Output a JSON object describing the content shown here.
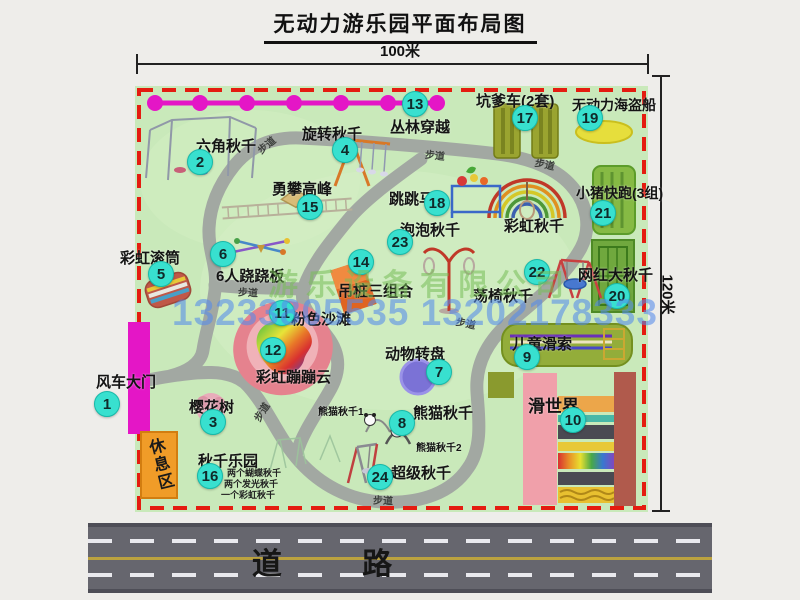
{
  "title": "无动力游乐园平面布局图",
  "dimensions": {
    "top": "100米",
    "right": "120米"
  },
  "road": {
    "label": "道 路"
  },
  "watermark": {
    "company": "游乐设备有限公司",
    "phone": "13233805535 13202178333"
  },
  "rest_area": {
    "label": "休息区"
  },
  "walkway_label": "步道",
  "walkway_positions": [
    [
      256,
      137,
      -40
    ],
    [
      425,
      147,
      6
    ],
    [
      535,
      156,
      12
    ],
    [
      238,
      284,
      3
    ],
    [
      251,
      404,
      -58
    ],
    [
      456,
      315,
      12
    ],
    [
      373,
      492,
      2
    ]
  ],
  "attractions": [
    {
      "num": "1",
      "name": "风车大门",
      "badge": [
        107,
        404
      ],
      "label": [
        96,
        371
      ]
    },
    {
      "num": "2",
      "name": "六角秋千",
      "badge": [
        200,
        162
      ],
      "label": [
        196,
        135
      ]
    },
    {
      "num": "3",
      "name": "樱花树",
      "badge": [
        213,
        422
      ],
      "label": [
        189,
        396
      ]
    },
    {
      "num": "4",
      "name": "旋转秋千",
      "badge": [
        345,
        150
      ],
      "label": [
        302,
        123
      ]
    },
    {
      "num": "5",
      "name": "彩虹滚筒",
      "badge": [
        161,
        274
      ],
      "label": [
        120,
        247
      ]
    },
    {
      "num": "6",
      "name": "6人跷跷板",
      "badge": [
        223,
        254
      ],
      "label": [
        216,
        265
      ]
    },
    {
      "num": "7",
      "name": "动物转盘",
      "badge": [
        439,
        372
      ],
      "label": [
        385,
        343
      ]
    },
    {
      "num": "8",
      "name": "熊猫秋千",
      "badge": [
        402,
        423
      ],
      "label": [
        413,
        402
      ]
    },
    {
      "num": "9",
      "name": "儿童滑索",
      "badge": [
        527,
        357
      ],
      "label": [
        512,
        333
      ]
    },
    {
      "num": "10",
      "name": "滑世界",
      "badge": [
        573,
        420
      ],
      "label": [
        528,
        392
      ],
      "size": 17
    },
    {
      "num": "11",
      "name": "粉色沙滩",
      "badge": [
        282,
        313
      ],
      "label": [
        291,
        308
      ]
    },
    {
      "num": "12",
      "name": "彩虹蹦蹦云",
      "badge": [
        273,
        350
      ],
      "label": [
        256,
        366
      ]
    },
    {
      "num": "13",
      "name": "丛林穿越",
      "badge": [
        415,
        104
      ],
      "label": [
        390,
        116
      ]
    },
    {
      "num": "14",
      "name": "吊桩三组合",
      "badge": [
        361,
        262
      ],
      "label": [
        338,
        280
      ]
    },
    {
      "num": "15",
      "name": "勇攀高峰",
      "badge": [
        310,
        207
      ],
      "label": [
        272,
        178
      ]
    },
    {
      "num": "16",
      "name": "秋千乐园",
      "badge": [
        210,
        476
      ],
      "label": [
        198,
        450
      ]
    },
    {
      "num": "17",
      "name": "坑爹车(2套)",
      "badge": [
        525,
        118
      ],
      "label": [
        476,
        90
      ]
    },
    {
      "num": "18",
      "name": "跳跳马",
      "badge": [
        437,
        203
      ],
      "label": [
        389,
        188
      ]
    },
    {
      "num": "19",
      "name": "无动力海盗船",
      "badge": [
        590,
        118
      ],
      "label": [
        572,
        95
      ],
      "size": 14
    },
    {
      "num": "20",
      "name": "网红大秋千",
      "badge": [
        617,
        296
      ],
      "label": [
        578,
        264
      ]
    },
    {
      "num": "21",
      "name": "小猪快跑(3组)",
      "badge": [
        603,
        213
      ],
      "label": [
        576,
        183
      ],
      "size": 14
    },
    {
      "num": "22",
      "name": "荡椅秋千",
      "badge": [
        537,
        272
      ],
      "label": [
        473,
        285
      ]
    },
    {
      "num": "23",
      "name": "泡泡秋千",
      "badge": [
        400,
        242
      ],
      "label": [
        400,
        219
      ]
    },
    {
      "num": "24",
      "name": "超级秋千",
      "badge": [
        380,
        477
      ],
      "label": [
        391,
        462
      ]
    }
  ],
  "unnumbered_labels": [
    {
      "name": "彩虹秋千",
      "pos": [
        504,
        215
      ],
      "size": 15
    },
    {
      "name": "熊猫秋千1",
      "pos": [
        318,
        403
      ],
      "size": 10
    },
    {
      "name": "熊猫秋千2",
      "pos": [
        416,
        439
      ],
      "size": 10
    }
  ],
  "swing_park_notes": [
    {
      "text": "两个蝴蝶秋千",
      "pos": [
        227,
        466
      ]
    },
    {
      "text": "两个发光秋千",
      "pos": [
        224,
        477
      ]
    },
    {
      "text": "一个彩虹秋千",
      "pos": [
        221,
        488
      ]
    }
  ],
  "colors": {
    "badge": "#38e0cf",
    "map_green": "#c9e9ba",
    "border_red": "#e41c10",
    "magenta": "#e416c6",
    "path_gray": "#a2a8a2",
    "road_gray": "#66666e",
    "rest_orange": "#f09c28"
  }
}
